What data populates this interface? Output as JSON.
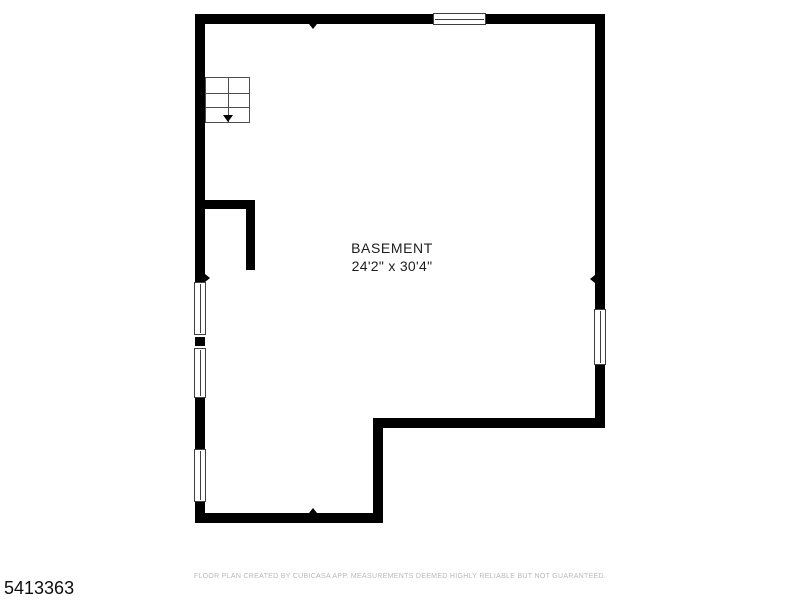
{
  "page": {
    "background_color": "#ffffff",
    "listing_id": "5413363",
    "disclaimer": "FLOOR PLAN CREATED BY CUBICASA APP. MEASUREMENTS DEEMED HIGHLY RELIABLE BUT NOT GUARANTEED."
  },
  "floorplan": {
    "room_label": "BASEMENT",
    "room_dimensions": "24'2\" x 30'4\"",
    "colors": {
      "wall": "#000000",
      "room_label_text": "#1d1d1d",
      "disclaimer_text": "#b9b9b9",
      "window_frame": "#3f3f3f",
      "stairs_lines": "#4d4d4d"
    },
    "icons": {
      "stairs": "stairs-icon (2x3 grid with down arrow)",
      "stairs_direction": "down-arrow-icon",
      "wall_markers": "wall-marker-icon (small triangles on top, bottom, left, right walls)",
      "windows": "window-symbol (white rect with center pane line)"
    },
    "window_count": 5,
    "wall_marker_count": 4
  }
}
